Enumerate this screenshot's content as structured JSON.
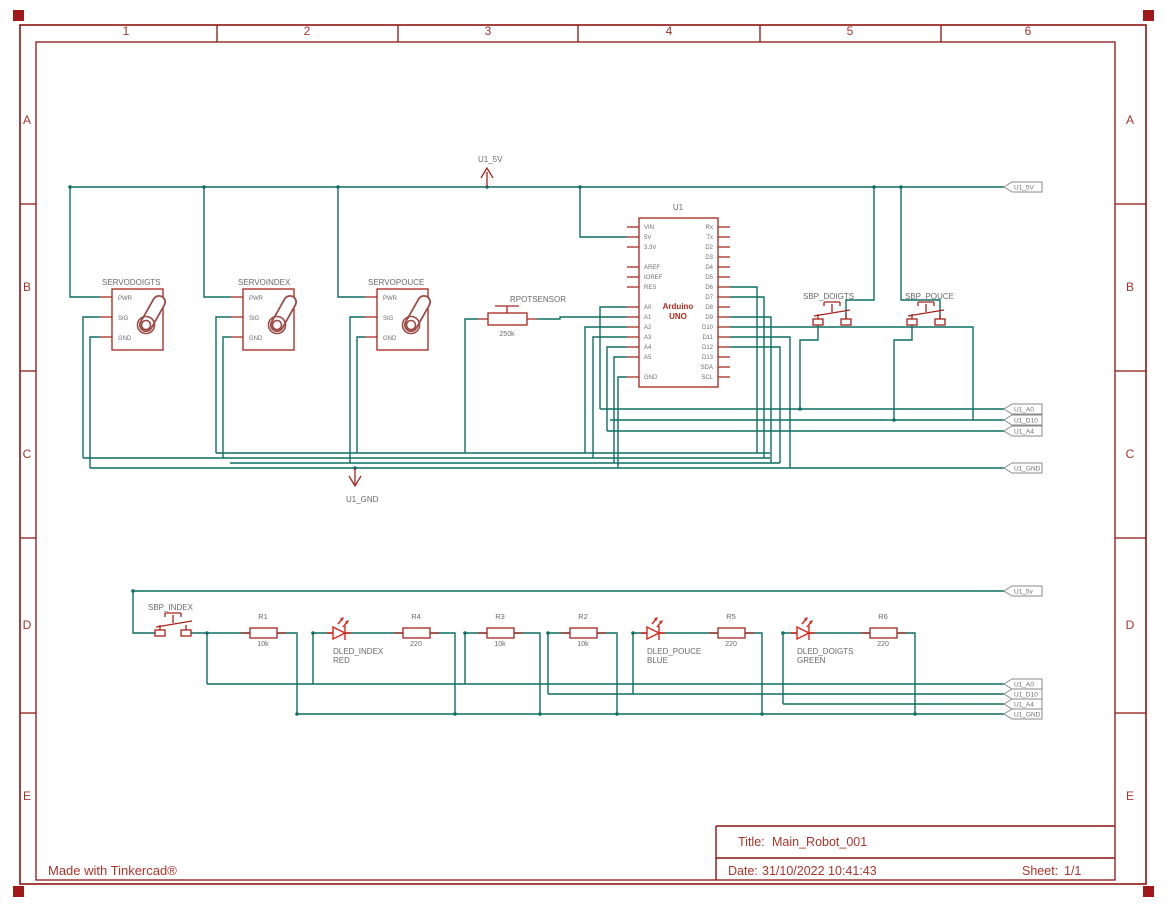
{
  "frame": {
    "columns": [
      "1",
      "2",
      "3",
      "4",
      "5",
      "6"
    ],
    "rows": [
      "A",
      "B",
      "C",
      "D",
      "E"
    ]
  },
  "credit": "Made with Tinkercad®",
  "title_block": {
    "title_label": "Title:",
    "title": "Main_Robot_001",
    "date_label": "Date:",
    "date": "31/10/2022 10:41:43",
    "sheet_label": "Sheet:",
    "sheet": "1/1"
  },
  "power": {
    "v5_label": "U1_5V",
    "gnd_label": "U1_GND"
  },
  "flags": {
    "top_5v": "U1_5V",
    "top_a0": "U1_A0",
    "top_d10": "U1_D10",
    "top_a4": "U1_A4",
    "top_gnd": "U1_GND",
    "bot_5v": "U1_5v",
    "bot_a0": "U1_A0",
    "bot_d10": "U1_D10",
    "bot_a4": "U1_A4",
    "bot_gnd": "U1_GND"
  },
  "servos": [
    {
      "name": "SERVODOIGTS",
      "pins": [
        "PWR",
        "SIG",
        "GND"
      ]
    },
    {
      "name": "SERVOINDEX",
      "pins": [
        "PWR",
        "SIG",
        "GND"
      ]
    },
    {
      "name": "SERVOPOUCE",
      "pins": [
        "PWR",
        "SIG",
        "GND"
      ]
    }
  ],
  "pot": {
    "name": "RPOTSENSOR",
    "value": "250k"
  },
  "arduino": {
    "refdes": "U1",
    "title1": "Arduino",
    "title2": "UNO",
    "left_pins": [
      "VIN",
      "5V",
      "3.3V",
      "AREF",
      "IOREF",
      "RES",
      "A0",
      "A1",
      "A2",
      "A3",
      "A4",
      "A5",
      "GND"
    ],
    "right_pins": [
      "Rx",
      "Tx",
      "D2",
      "D3",
      "D4",
      "D5",
      "D6",
      "D7",
      "D8",
      "D9",
      "D10",
      "D11",
      "D12",
      "D13",
      "SDA",
      "SCL"
    ]
  },
  "buttons": [
    {
      "name": "SBP_DOIGTS"
    },
    {
      "name": "SBP_POUCE"
    },
    {
      "name": "SBP_INDEX"
    }
  ],
  "resistors": [
    {
      "name": "R1",
      "value": "10k"
    },
    {
      "name": "R4",
      "value": "220"
    },
    {
      "name": "R3",
      "value": "10k"
    },
    {
      "name": "R2",
      "value": "10k"
    },
    {
      "name": "R5",
      "value": "220"
    },
    {
      "name": "R6",
      "value": "220"
    }
  ],
  "leds": [
    {
      "name": "DLED_INDEX",
      "color_label": "RED"
    },
    {
      "name": "DLED_POUCE",
      "color_label": "BLUE"
    },
    {
      "name": "DLED_DOIGTS",
      "color_label": "GREEN"
    }
  ],
  "colors": {
    "wire": "#0d6f63",
    "component": "#a8241b",
    "led_accent": "#d8271c",
    "label": "#696969",
    "frame": "#8c1510",
    "title_text": "#ac352b"
  }
}
